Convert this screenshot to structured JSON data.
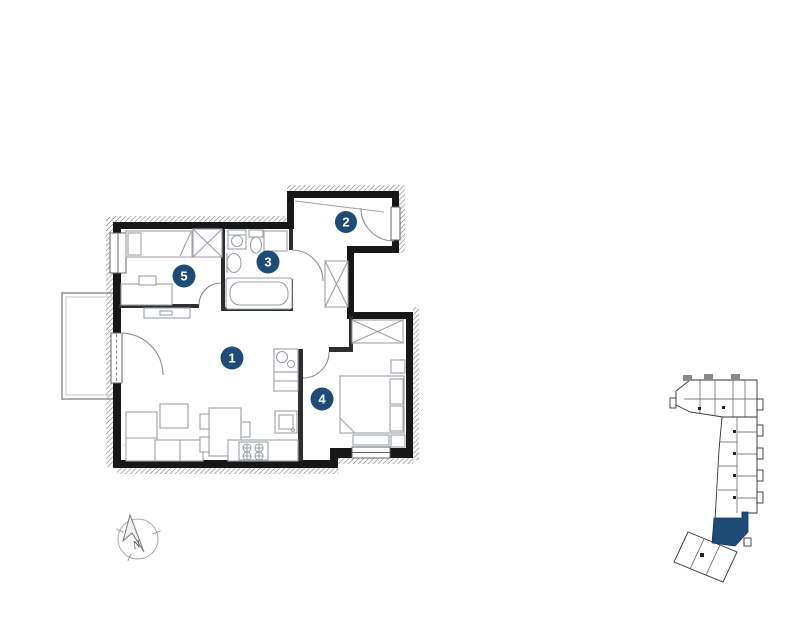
{
  "plan": {
    "room_markers": [
      {
        "number": "1"
      },
      {
        "number": "2"
      },
      {
        "number": "3"
      },
      {
        "number": "4"
      },
      {
        "number": "5"
      }
    ],
    "marker_color": "#1e4b77",
    "compass": {
      "north_label": "N"
    }
  },
  "locator": {
    "highlight_color": "#1e4b77"
  }
}
